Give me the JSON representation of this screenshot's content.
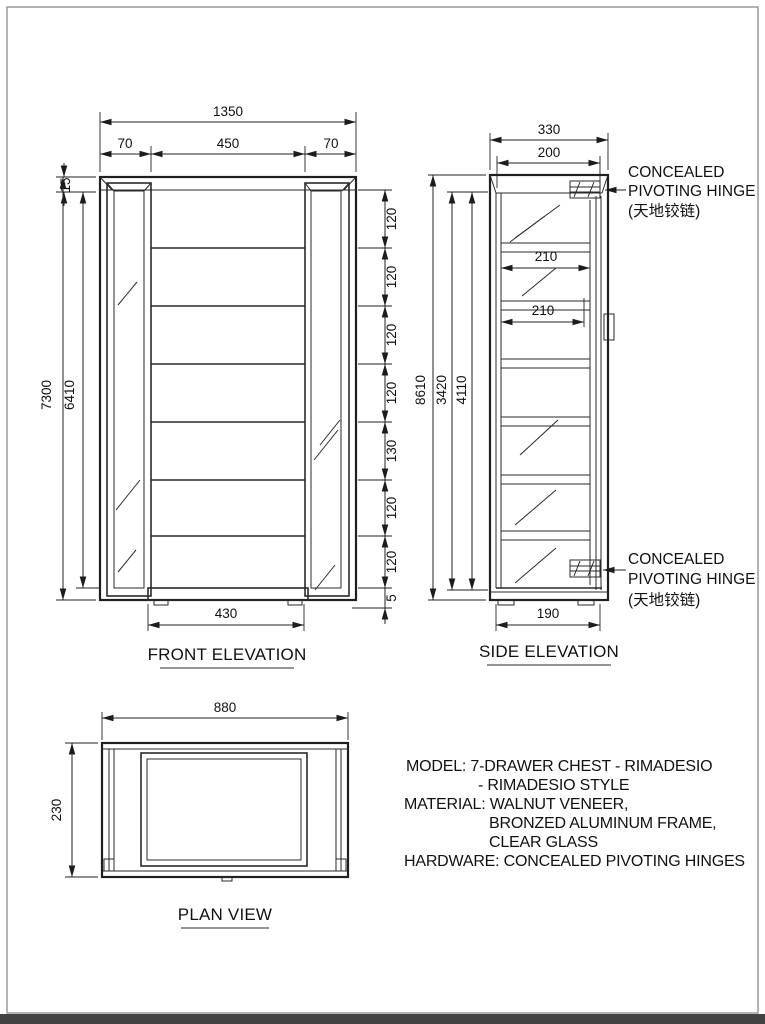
{
  "page": {
    "background": "#ffffff",
    "line_color": "#2a2a2a",
    "border_color": "#9a9a9a",
    "footer_bar_color": "#424242"
  },
  "views": {
    "front": {
      "label": "FRONT ELEVATION",
      "dims": {
        "overall_width": "1350",
        "left_door_width": "70",
        "center_width": "450",
        "right_door_width": "70",
        "top_thickness": "15",
        "overall_height": "7300",
        "inner_height": "6410",
        "segments": [
          "120",
          "120",
          "120",
          "120",
          "130",
          "120",
          "120",
          "5"
        ],
        "base_width": "430"
      }
    },
    "side": {
      "label": "SIDE ELEVATION",
      "dims": {
        "overall_depth": "330",
        "inner_depth": "200",
        "drawer_depth_upper": "210",
        "drawer_depth_lower": "210",
        "overall_height": "8610",
        "height_a": "3420",
        "height_b": "4110",
        "base_depth": "190"
      },
      "hinge_top": {
        "line1": "CONCEALED",
        "line2": "PIVOTING HINGE",
        "line3": "(天地铰链)"
      },
      "hinge_bottom": {
        "line1": "CONCEALED",
        "line2": "PIVOTING HINGE",
        "line3": "(天地铰链)"
      }
    },
    "plan": {
      "label": "PLAN VIEW",
      "dims": {
        "width": "880",
        "depth": "230"
      }
    }
  },
  "spec": {
    "lines": [
      "MODEL: 7-DRAWER CHEST - RIMADESIO",
      "- RIMADESIO STYLE",
      "MATERIAL: WALNUT VENEER,",
      "BRONZED ALUMINUM FRAME,",
      "CLEAR GLASS",
      "HARDWARE: CONCEALED PIVOTING HINGES"
    ]
  }
}
